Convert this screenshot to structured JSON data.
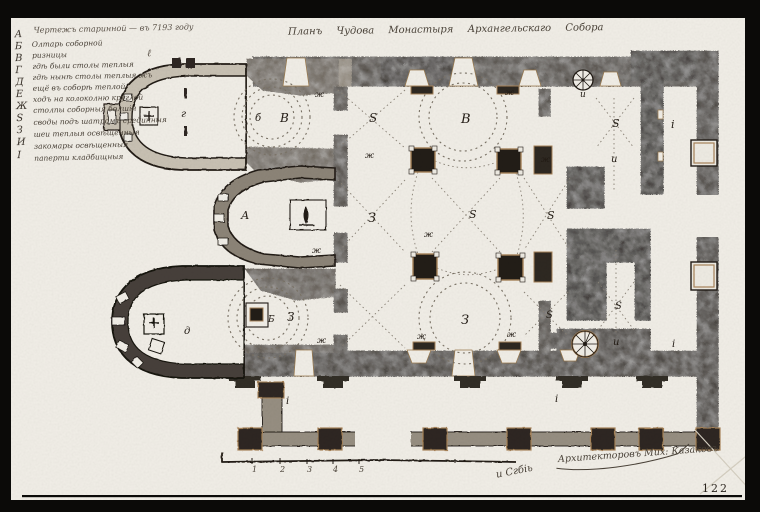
{
  "photo": {
    "page_number": "122"
  },
  "title": {
    "text": "Планъ Чудова Монастыря Архангельскаго Собора"
  },
  "legend": {
    "header": "Чертежъ старинной — въ 7193 году",
    "note_mark": "ℓ",
    "letters": [
      {
        "ch": "А",
        "y": 35
      },
      {
        "ch": "Б",
        "y": 47
      },
      {
        "ch": "В",
        "y": 59
      },
      {
        "ch": "Г",
        "y": 71
      },
      {
        "ch": "Д",
        "y": 83
      },
      {
        "ch": "Е",
        "y": 95
      },
      {
        "ch": "Ж",
        "y": 107
      },
      {
        "ch": "S",
        "y": 119
      },
      {
        "ch": "З",
        "y": 131
      },
      {
        "ch": "И",
        "y": 143
      },
      {
        "ch": "І",
        "y": 156
      }
    ],
    "lines": [
      {
        "y": 45,
        "text": "Олтарь соборной"
      },
      {
        "y": 56,
        "text": "ризницы"
      },
      {
        "y": 67,
        "text": "гдѣ были столы теплыя"
      },
      {
        "y": 78,
        "text": "гдѣ нынѣ столы теплыя жъ"
      },
      {
        "y": 89,
        "text": "ещё въ соборѣ теплой"
      },
      {
        "y": 100,
        "text": "ходъ на колоколню круглой"
      },
      {
        "y": 111,
        "text": "столпы соборныя болшія"
      },
      {
        "y": 123,
        "text": "своды подъ шатромъ срединныя"
      },
      {
        "y": 135,
        "text": "шеи теплыя освѣщенныя"
      },
      {
        "y": 147,
        "text": "закомары освѣщенныя"
      },
      {
        "y": 159,
        "text": "паперти кладбищныя"
      }
    ]
  },
  "plan_labels": [
    {
      "text": "г",
      "x": 181,
      "y": 117,
      "s": 10
    },
    {
      "text": "б",
      "x": 255,
      "y": 121,
      "s": 10
    },
    {
      "text": "В",
      "x": 280,
      "y": 122,
      "s": 12
    },
    {
      "text": "ж",
      "x": 315,
      "y": 97,
      "s": 8
    },
    {
      "text": "S",
      "x": 369,
      "y": 122,
      "s": 12
    },
    {
      "text": "В",
      "x": 461,
      "y": 123,
      "s": 13
    },
    {
      "text": "ж",
      "x": 505,
      "y": 95,
      "s": 8
    },
    {
      "text": "ж",
      "x": 365,
      "y": 158,
      "s": 8
    },
    {
      "text": "ж",
      "x": 541,
      "y": 162,
      "s": 8
    },
    {
      "text": "и",
      "x": 580,
      "y": 97,
      "s": 9
    },
    {
      "text": "S",
      "x": 612,
      "y": 127,
      "s": 11
    },
    {
      "text": "и",
      "x": 611,
      "y": 162,
      "s": 10
    },
    {
      "text": "і",
      "x": 671,
      "y": 128,
      "s": 11
    },
    {
      "text": "А",
      "x": 241,
      "y": 219,
      "s": 11
    },
    {
      "text": "ж",
      "x": 312,
      "y": 253,
      "s": 8
    },
    {
      "text": "З",
      "x": 368,
      "y": 222,
      "s": 13
    },
    {
      "text": "ж",
      "x": 424,
      "y": 237,
      "s": 8
    },
    {
      "text": "S",
      "x": 469,
      "y": 218,
      "s": 11
    },
    {
      "text": "S",
      "x": 547,
      "y": 219,
      "s": 11
    },
    {
      "text": "S",
      "x": 546,
      "y": 318,
      "s": 10
    },
    {
      "text": "д",
      "x": 184,
      "y": 334,
      "s": 10
    },
    {
      "text": "Б",
      "x": 268,
      "y": 322,
      "s": 9
    },
    {
      "text": "З",
      "x": 287,
      "y": 321,
      "s": 12
    },
    {
      "text": "ж",
      "x": 317,
      "y": 343,
      "s": 8
    },
    {
      "text": "З",
      "x": 461,
      "y": 324,
      "s": 13
    },
    {
      "text": "ж",
      "x": 417,
      "y": 339,
      "s": 8
    },
    {
      "text": "ж",
      "x": 507,
      "y": 337,
      "s": 8
    },
    {
      "text": "S",
      "x": 615,
      "y": 309,
      "s": 10
    },
    {
      "text": "и",
      "x": 613,
      "y": 345,
      "s": 10
    },
    {
      "text": "і",
      "x": 672,
      "y": 347,
      "s": 10
    },
    {
      "text": "і",
      "x": 286,
      "y": 404,
      "s": 10
    },
    {
      "text": "і",
      "x": 555,
      "y": 402,
      "s": 10
    }
  ],
  "scale": {
    "numbers": [
      {
        "n": "1",
        "x": 252
      },
      {
        "n": "2",
        "x": 280
      },
      {
        "n": "3",
        "x": 307
      },
      {
        "n": "4",
        "x": 333
      },
      {
        "n": "5",
        "x": 359
      }
    ]
  },
  "signature": {
    "left": "и Сгбіь",
    "main": "Архитекторовъ Мих: Казаковъ"
  },
  "colors": {
    "paper": "#f2efe8",
    "ink": "#201a14",
    "wall_dark": "#2e2821",
    "wall_mid": "#5a5248",
    "wall_gray": "#8d8578",
    "wall_light": "#c9c2b4",
    "tan": "#a8845a"
  }
}
